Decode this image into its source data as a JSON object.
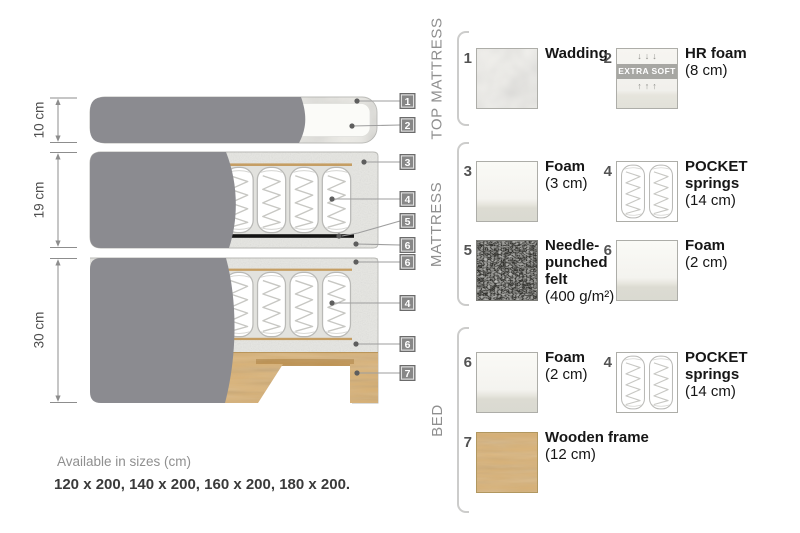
{
  "diagram": {
    "dimension_labels": [
      "10 cm",
      "19 cm",
      "30 cm"
    ],
    "tag_numbers": [
      "1",
      "2",
      "3",
      "4",
      "5",
      "6",
      "6",
      "4",
      "6",
      "7"
    ]
  },
  "legend": {
    "sections": [
      {
        "title": "TOP MATTRESS",
        "items": [
          {
            "num": "1",
            "name": "Wadding",
            "size": ""
          },
          {
            "num": "2",
            "name": "HR foam",
            "size": "(8 cm)",
            "badge": "EXTRA SOFT",
            "arrows_down": "↓↓↓",
            "arrows_up": "↑↑↑"
          }
        ]
      },
      {
        "title": "MATTRESS",
        "items": [
          {
            "num": "3",
            "name": "Foam",
            "size": "(3 cm)"
          },
          {
            "num": "4",
            "name": "POCKET springs",
            "size": "(14 cm)"
          },
          {
            "num": "5",
            "name": "Needle-punched felt",
            "size": "(400 g/m²)"
          },
          {
            "num": "6",
            "name": "Foam",
            "size": "(2 cm)"
          }
        ]
      },
      {
        "title": "BED",
        "items": [
          {
            "num": "6",
            "name": "Foam",
            "size": "(2 cm)"
          },
          {
            "num": "4",
            "name": "POCKET springs",
            "size": "(14 cm)"
          },
          {
            "num": "7",
            "name": "Wooden frame",
            "size": "(12 cm)"
          }
        ]
      }
    ]
  },
  "footer": {
    "available": "Available in sizes (cm)",
    "sizes": "120 x 200, 140 x 200, 160 x 200, 180 x 200."
  },
  "colors": {
    "fabric_gray": "#8b8b90",
    "wood_tan": "#d9b173",
    "felt_gray": "#76766f",
    "tag_gray": "#878787"
  }
}
